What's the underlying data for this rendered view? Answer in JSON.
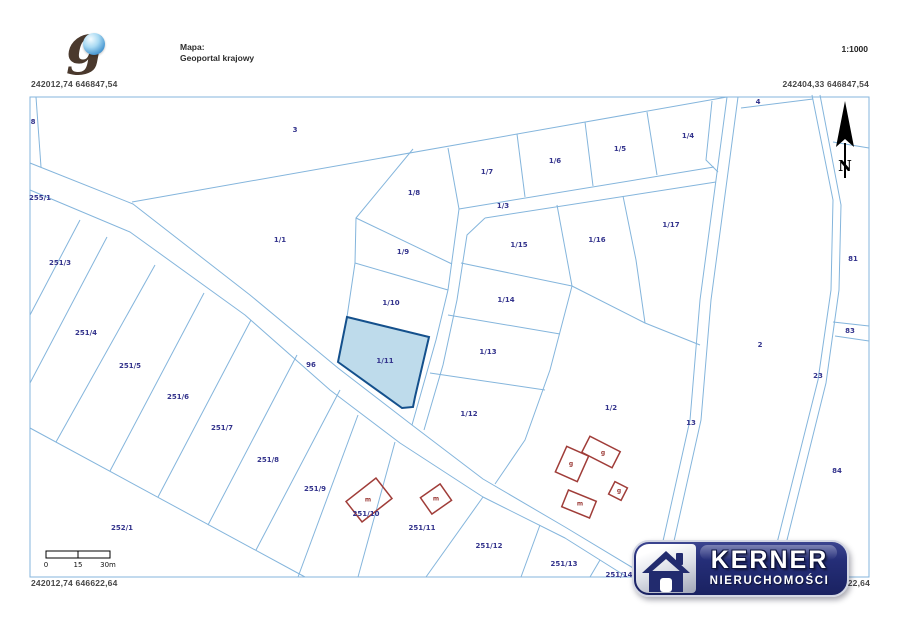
{
  "header": {
    "logo_letter": "g",
    "map_label": "Mapa:",
    "map_name": "Geoportal krajowy",
    "scale": "1:1000"
  },
  "coords": {
    "top_left": "242012,74 646847,54",
    "top_right": "242404,33 646847,54",
    "bottom_left": "242012,74 646622,64",
    "bottom_right_visible": "622,64"
  },
  "north": "N",
  "scalebar": {
    "t0": "0",
    "t1": "15",
    "t2": "30m"
  },
  "map": {
    "highlighted_parcel": "1/11",
    "colors": {
      "boundary": "#84b5dc",
      "highlight_fill": "#b7d7e9",
      "highlight_stroke": "#14508c",
      "parcel_label": "#33338c",
      "building": "#a03d39"
    },
    "labels": [
      {
        "t": "8",
        "x": 33,
        "y": 122,
        "k": "p"
      },
      {
        "t": "255/1",
        "x": 40,
        "y": 198,
        "k": "p"
      },
      {
        "t": "3",
        "x": 295,
        "y": 130,
        "k": "p"
      },
      {
        "t": "1/1",
        "x": 280,
        "y": 240,
        "k": "p"
      },
      {
        "t": "251/3",
        "x": 60,
        "y": 263,
        "k": "p"
      },
      {
        "t": "251/4",
        "x": 86,
        "y": 333,
        "k": "p"
      },
      {
        "t": "251/5",
        "x": 130,
        "y": 366,
        "k": "p"
      },
      {
        "t": "251/6",
        "x": 178,
        "y": 397,
        "k": "p"
      },
      {
        "t": "251/7",
        "x": 222,
        "y": 428,
        "k": "p"
      },
      {
        "t": "251/8",
        "x": 268,
        "y": 460,
        "k": "p"
      },
      {
        "t": "251/9",
        "x": 315,
        "y": 489,
        "k": "p"
      },
      {
        "t": "252/1",
        "x": 122,
        "y": 528,
        "k": "p"
      },
      {
        "t": "251/10",
        "x": 366,
        "y": 514,
        "k": "p"
      },
      {
        "t": "251/11",
        "x": 422,
        "y": 528,
        "k": "p"
      },
      {
        "t": "251/12",
        "x": 489,
        "y": 546,
        "k": "p"
      },
      {
        "t": "251/13",
        "x": 564,
        "y": 564,
        "k": "p"
      },
      {
        "t": "251/14",
        "x": 619,
        "y": 575,
        "k": "p"
      },
      {
        "t": "96",
        "x": 311,
        "y": 365,
        "k": "p"
      },
      {
        "t": "1/8",
        "x": 414,
        "y": 193,
        "k": "p"
      },
      {
        "t": "1/7",
        "x": 487,
        "y": 172,
        "k": "p"
      },
      {
        "t": "1/6",
        "x": 555,
        "y": 161,
        "k": "p"
      },
      {
        "t": "1/5",
        "x": 620,
        "y": 149,
        "k": "p"
      },
      {
        "t": "1/4",
        "x": 688,
        "y": 136,
        "k": "p"
      },
      {
        "t": "4",
        "x": 758,
        "y": 102,
        "k": "p"
      },
      {
        "t": "1/3",
        "x": 503,
        "y": 206,
        "k": "p"
      },
      {
        "t": "1/9",
        "x": 403,
        "y": 252,
        "k": "p"
      },
      {
        "t": "1/10",
        "x": 391,
        "y": 303,
        "k": "p"
      },
      {
        "t": "1/11",
        "x": 385,
        "y": 361,
        "k": "p"
      },
      {
        "t": "1/15",
        "x": 519,
        "y": 245,
        "k": "p"
      },
      {
        "t": "1/16",
        "x": 597,
        "y": 240,
        "k": "p"
      },
      {
        "t": "1/17",
        "x": 671,
        "y": 225,
        "k": "p"
      },
      {
        "t": "1/14",
        "x": 506,
        "y": 300,
        "k": "p"
      },
      {
        "t": "1/13",
        "x": 488,
        "y": 352,
        "k": "p"
      },
      {
        "t": "1/12",
        "x": 469,
        "y": 414,
        "k": "p"
      },
      {
        "t": "1/2",
        "x": 611,
        "y": 408,
        "k": "p"
      },
      {
        "t": "2",
        "x": 760,
        "y": 345,
        "k": "p"
      },
      {
        "t": "13",
        "x": 691,
        "y": 423,
        "k": "p"
      },
      {
        "t": "23",
        "x": 818,
        "y": 376,
        "k": "p"
      },
      {
        "t": "81",
        "x": 853,
        "y": 259,
        "k": "p"
      },
      {
        "t": "83",
        "x": 850,
        "y": 331,
        "k": "p"
      },
      {
        "t": "84",
        "x": 837,
        "y": 471,
        "k": "p"
      },
      {
        "t": "m",
        "x": 368,
        "y": 500,
        "k": "b"
      },
      {
        "t": "m",
        "x": 436,
        "y": 499,
        "k": "b"
      },
      {
        "t": "g",
        "x": 603,
        "y": 453,
        "k": "b"
      },
      {
        "t": "g",
        "x": 571,
        "y": 464,
        "k": "b"
      },
      {
        "t": "g",
        "x": 619,
        "y": 491,
        "k": "b"
      },
      {
        "t": "m",
        "x": 580,
        "y": 504,
        "k": "b"
      }
    ]
  },
  "watermark": {
    "brand": "KERNER",
    "subtitle": "NIERUCHOMOŚCI"
  }
}
